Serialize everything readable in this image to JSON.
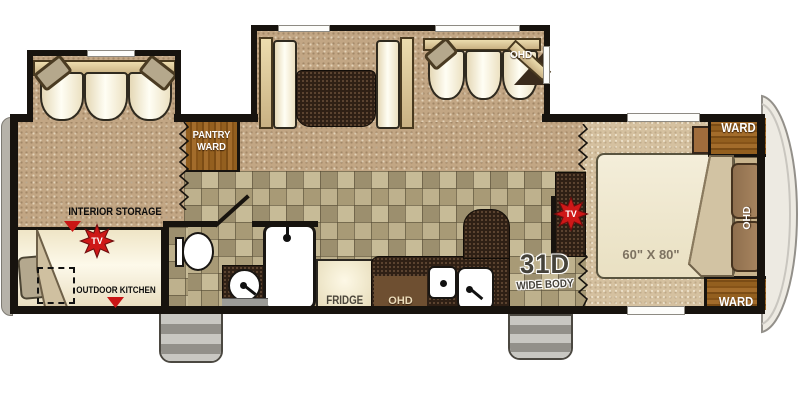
{
  "floorplan": {
    "model": "31D",
    "model_sub": "WIDE BODY",
    "bed_size": "60\" X 80\"",
    "labels": {
      "pantry_line1": "PANTRY",
      "pantry_line2": "WARD",
      "dinette_sofa_ohd": "OHD",
      "interior_storage": "INTERIOR STORAGE",
      "tv": "TV",
      "outdoor_kitchen": "OUTDOOR KITCHEN",
      "fridge": "FRIDGE",
      "kitchen_ohd": "OHD",
      "bedroom_ohd": "OHD",
      "ward_top": "WARD",
      "ward_bottom": "WARD"
    },
    "colors": {
      "accent_red": "#ce1818",
      "wall_black": "#17130e",
      "carpet_tan": "#c2a684",
      "bedroom_carpet": "#d5c1a0",
      "wood_brown": "#8a5a23",
      "counter_dark": "#2f2015",
      "cushion_cream": "#f4ecd4",
      "steps_gray": "#c8c7c2"
    }
  }
}
